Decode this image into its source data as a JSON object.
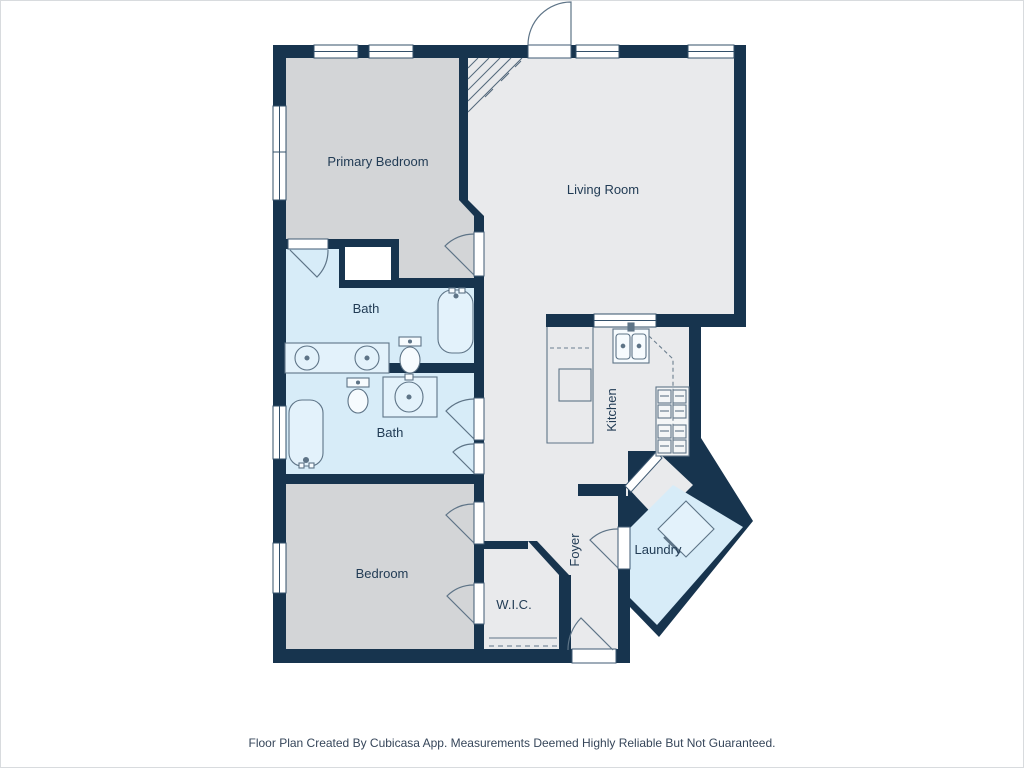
{
  "rooms": {
    "primary_bedroom": "Primary Bedroom",
    "living_room": "Living Room",
    "bath_upper": "Bath",
    "bath_lower": "Bath",
    "bedroom": "Bedroom",
    "kitchen": "Kitchen",
    "foyer": "Foyer",
    "laundry": "Laundry",
    "wic": "W.I.C."
  },
  "footer": {
    "text": "Floor Plan Created By Cubicasa App. Measurements Deemed Highly Reliable But Not Guaranteed."
  },
  "colors": {
    "wall": "#17344E",
    "bedroom_fill": "#D3D5D7",
    "living_fill": "#E9EAEC",
    "wet_room_fill": "#D7ECF8",
    "fixture_line": "#5E7487",
    "label_text": "#223C55"
  }
}
